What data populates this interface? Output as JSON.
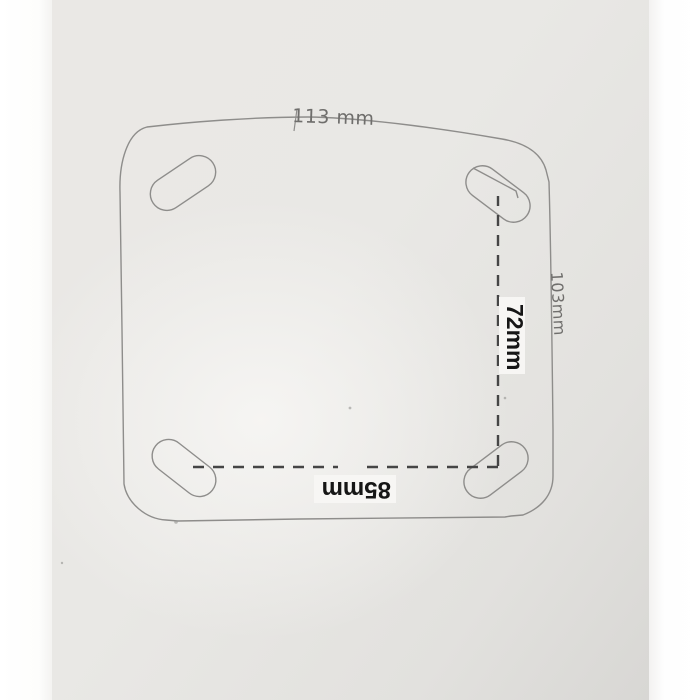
{
  "sketch": {
    "labels": {
      "top_width": "113 mm",
      "side_height": "103mm",
      "bolt_spacing_vertical": "72mm",
      "bolt_spacing_horizontal": "85mm"
    },
    "colors": {
      "pencil_line": "#8e8d8b",
      "dashed_line": "#454545",
      "handwritten_text": "#6f6e6c",
      "printed_label_text": "#161616",
      "printed_label_bg": "#f7f6f4"
    }
  }
}
